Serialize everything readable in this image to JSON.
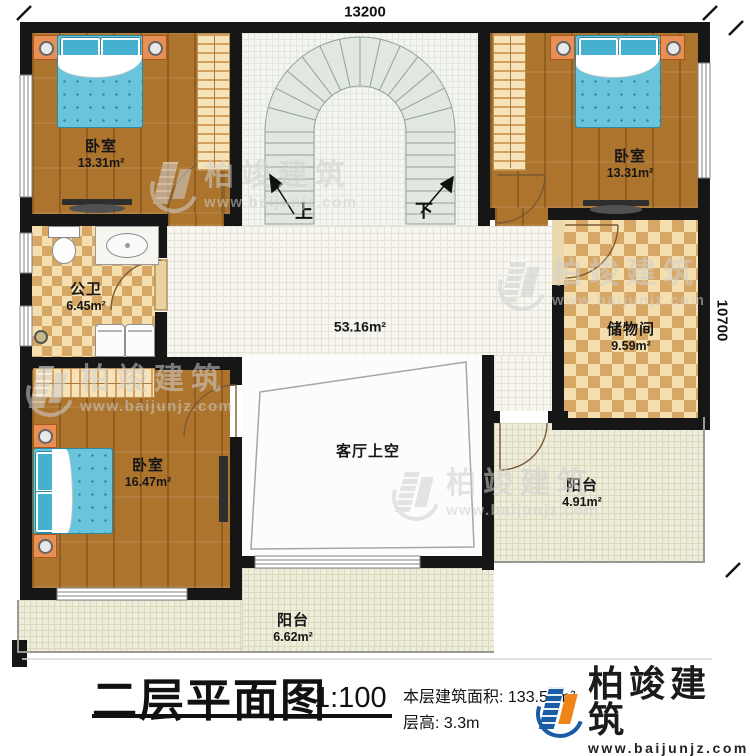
{
  "dims": {
    "width_label": "13200",
    "height_label": "10700"
  },
  "rooms": {
    "bedroom_tl": {
      "name": "卧室",
      "area": "13.31m²"
    },
    "bedroom_tr": {
      "name": "卧室",
      "area": "13.31m²"
    },
    "bathroom": {
      "name": "公卫",
      "area": "6.45m²"
    },
    "storage": {
      "name": "储物间",
      "area": "9.59m²"
    },
    "bedroom_bl": {
      "name": "卧室",
      "area": "16.47m²"
    },
    "hall": {
      "area": "53.16m²"
    },
    "void": {
      "name": "客厅上空"
    },
    "balcony_right": {
      "name": "阳台",
      "area": "4.91m²"
    },
    "balcony_bottom": {
      "name": "阳台",
      "area": "6.62m²"
    }
  },
  "stairs": {
    "up": "上",
    "down": "下"
  },
  "titleblock": {
    "title": "二层平面图",
    "scale": "1:100",
    "floor_area": "本层建筑面积: 133.59m²",
    "floor_height": "层高: 3.3m"
  },
  "brand": {
    "name": "柏竣建筑",
    "url": "www.baijunjz.com"
  },
  "watermark": {
    "name": "柏竣建筑",
    "url": "www.baijunjz.com"
  },
  "colors": {
    "brand_blue": "#1a5ca6",
    "brand_orange": "#ef8418",
    "wall": "#161616"
  }
}
